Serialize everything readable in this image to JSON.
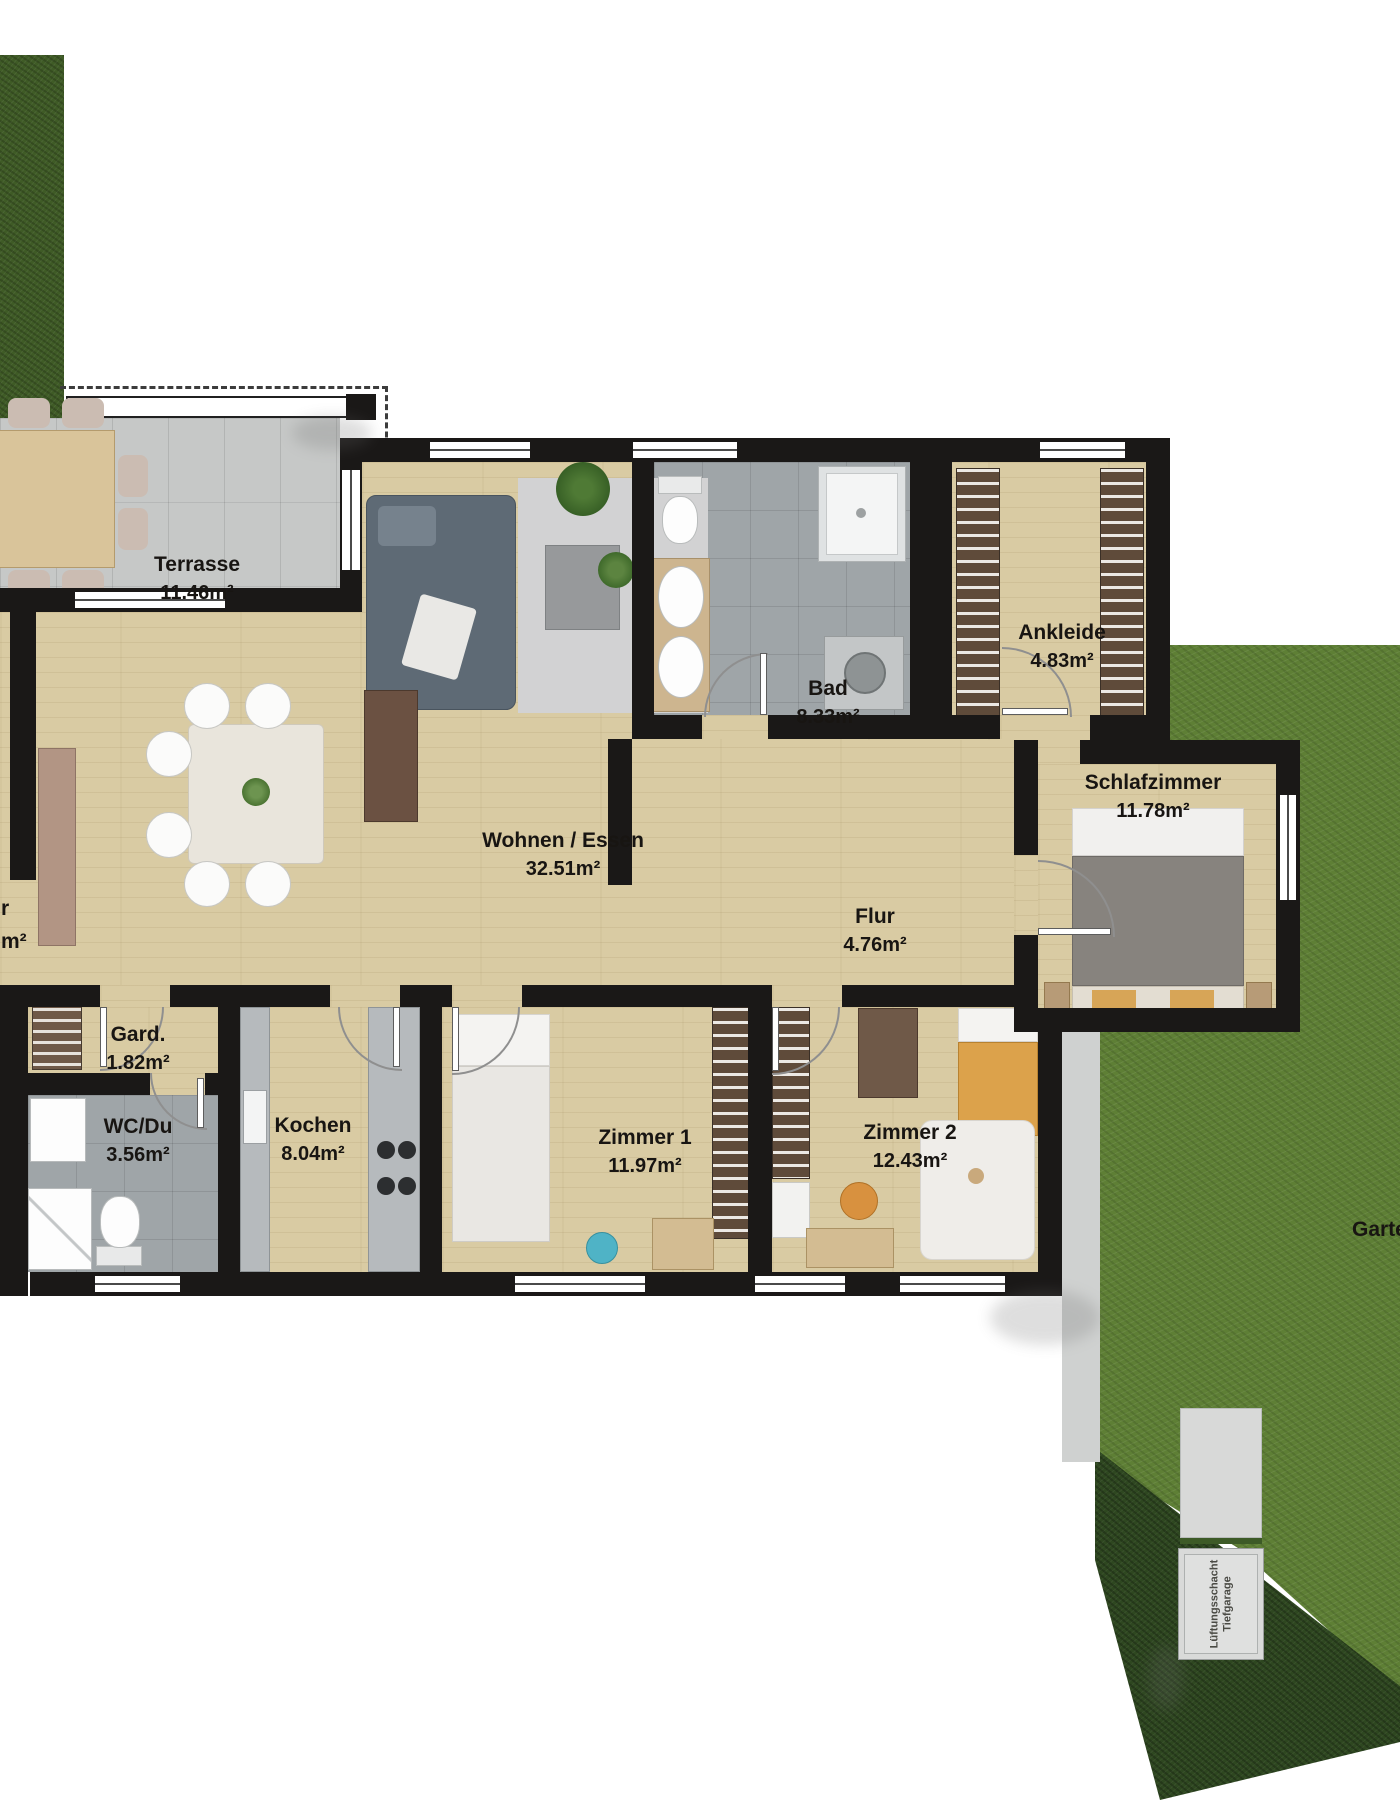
{
  "rooms": [
    {
      "name": "Terrasse",
      "area": "11.46m²"
    },
    {
      "name": "Wohnen / Essen",
      "area": "32.51m²"
    },
    {
      "name": "Bad",
      "area": "8.33m²"
    },
    {
      "name": "Ankleide",
      "area": "4.83m²"
    },
    {
      "name": "Schlafzimmer",
      "area": "11.78m²"
    },
    {
      "name": "Flur",
      "area": "4.76m²"
    },
    {
      "name": "Gard.",
      "area": "1.82m²"
    },
    {
      "name": "WC/Du",
      "area": "3.56m²"
    },
    {
      "name": "Kochen",
      "area": "8.04m²"
    },
    {
      "name": "Zimmer 1",
      "area": "11.97m²"
    },
    {
      "name": "Zimmer 2",
      "area": "12.43m²"
    }
  ],
  "outdoor": {
    "garden_label": "Garten",
    "left_partial_line1": "r",
    "left_partial_line2": "m²",
    "shaft_label_line1": "Lüftungsschacht",
    "shaft_label_line2": "Tiefgarage"
  },
  "colors": {
    "wall": "#1a1817",
    "wood_floor": "#d9cba3",
    "terrace_tile": "#c6c8c7",
    "bath_tile": "#9fa5a8",
    "hedge": "#3f5b26",
    "garden": "#5e7f35",
    "garden_dark": "#2e4720",
    "label_text": "#181512"
  }
}
